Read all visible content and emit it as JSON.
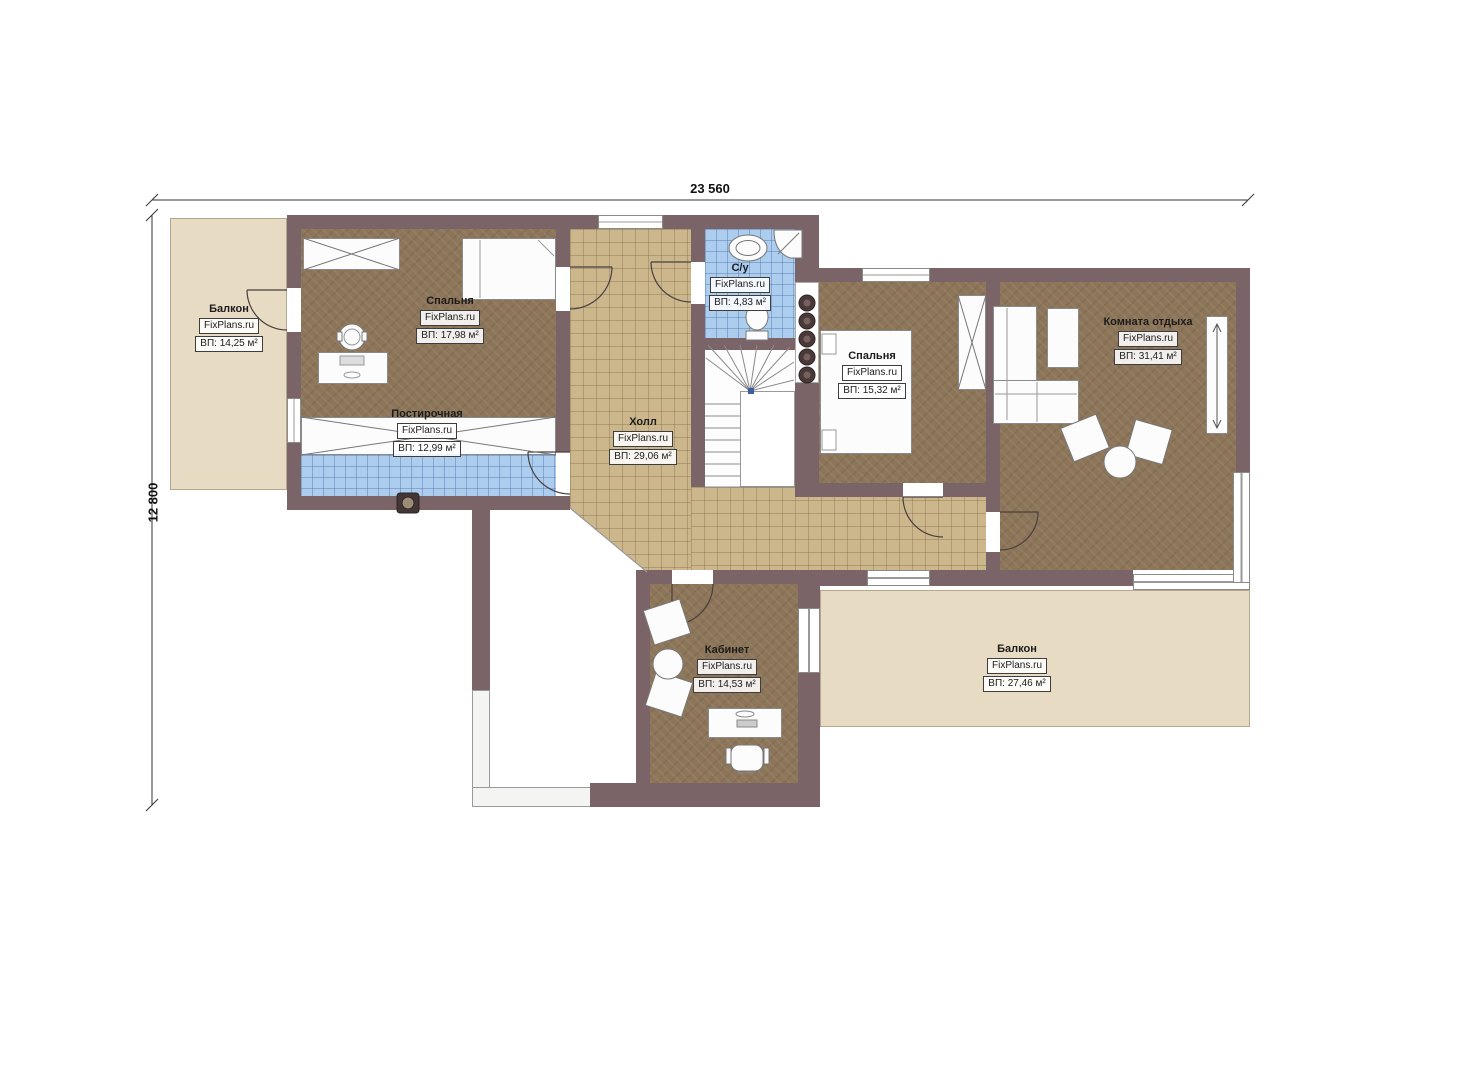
{
  "dimensions": {
    "width_label": "23 560",
    "height_label": "12 800"
  },
  "rooms": {
    "balcony_left": {
      "name": "Балкон",
      "brand": "FixPlans.ru",
      "area": "ВП: 14,25 м²"
    },
    "bedroom1": {
      "name": "Спальня",
      "brand": "FixPlans.ru",
      "area": "ВП: 17,98 м²"
    },
    "laundry": {
      "name": "Постирочная",
      "brand": "FixPlans.ru",
      "area": "ВП: 12,99 м²"
    },
    "hall": {
      "name": "Холл",
      "brand": "FixPlans.ru",
      "area": "ВП: 29,06 м²"
    },
    "bathroom": {
      "name": "С/у",
      "brand": "FixPlans.ru",
      "area": "ВП: 4,83 м²"
    },
    "bedroom2": {
      "name": "Спальня",
      "brand": "FixPlans.ru",
      "area": "ВП: 15,32 м²"
    },
    "lounge": {
      "name": "Комната отдыха",
      "brand": "FixPlans.ru",
      "area": "ВП: 31,41 м²"
    },
    "office": {
      "name": "Кабинет",
      "brand": "FixPlans.ru",
      "area": "ВП: 14,53 м²"
    },
    "balcony_bottom": {
      "name": "Балкон",
      "brand": "FixPlans.ru",
      "area": "ВП: 27,46 м²"
    }
  },
  "colors": {
    "wall": "#7a6467",
    "floor": "#8c7558",
    "tile": "#ccb78d",
    "wet": "#accdee",
    "balcony": "#e7dbc4"
  }
}
